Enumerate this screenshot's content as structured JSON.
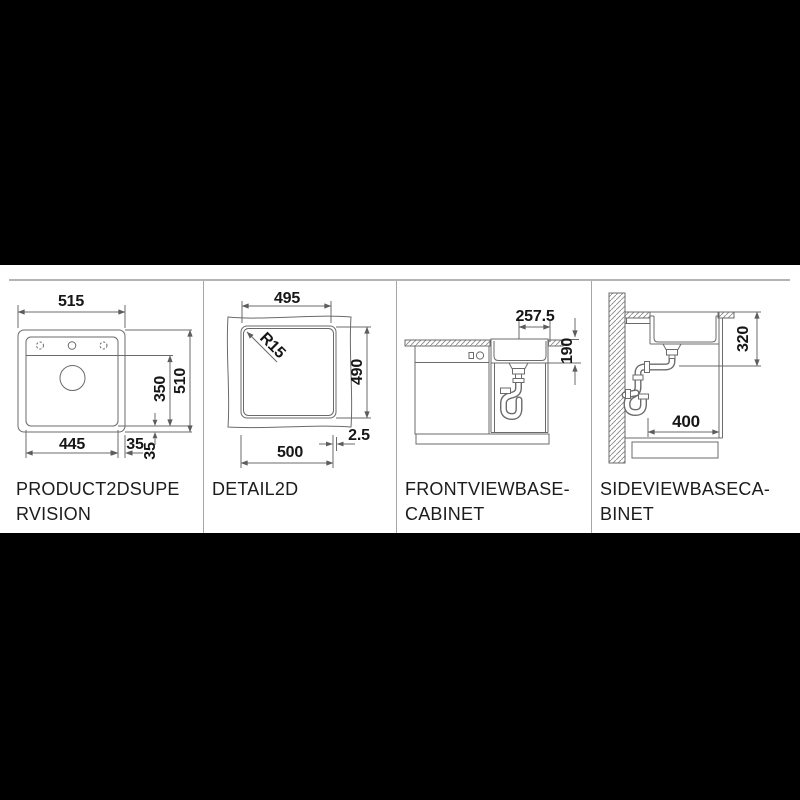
{
  "sheet": {
    "page_background": "#000000",
    "background": "#ffffff",
    "line_color": "#6b6b6b",
    "text_color": "#161616"
  },
  "panels": [
    {
      "id": "product2dsupervision",
      "label_lines": [
        "PRODUCT2DSUPE",
        "RVISION"
      ],
      "dims": {
        "overall_width": "515",
        "bowl_depth_front": "350",
        "overall_depth": "510",
        "cutout_bottom_width": "445",
        "offset_right": "35",
        "offset_bottom": "35"
      }
    },
    {
      "id": "detail2d",
      "label_lines": [
        "DETAIL2D"
      ],
      "dims": {
        "inner_width": "495",
        "corner_radius": "R15",
        "inner_height": "490",
        "cutout_width": "500",
        "edge_gap": "2.5"
      }
    },
    {
      "id": "frontviewbasecabinet",
      "label_lines": [
        "FRONTVIEWBASE-",
        "CABINET"
      ],
      "dims": {
        "drain_offset": "257.5",
        "bowl_depth": "190"
      }
    },
    {
      "id": "sideviewbasecabinet",
      "label_lines": [
        "SIDEVIEWBASECA-",
        "BINET"
      ],
      "dims": {
        "installation_depth": "320",
        "clearance": "400"
      }
    }
  ]
}
